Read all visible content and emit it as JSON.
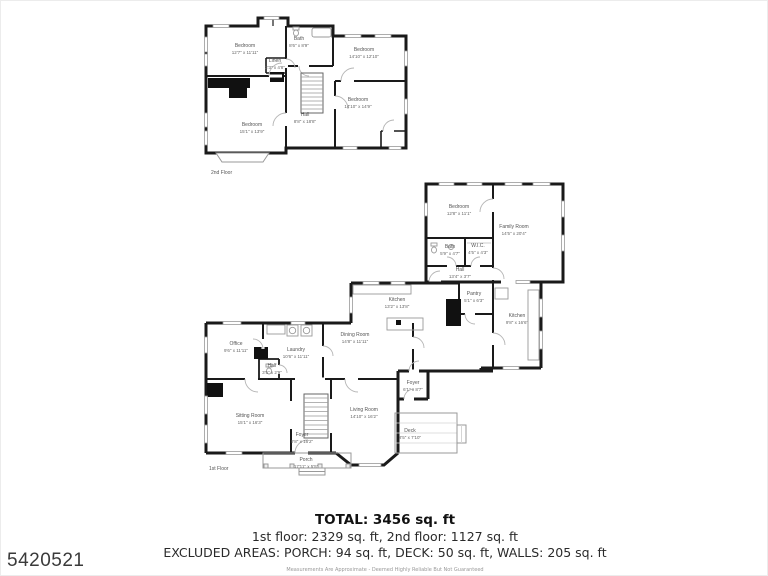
{
  "watermark": "5420521",
  "floor2": {
    "floor_label": "2nd Floor",
    "rooms": [
      {
        "name": "Bedroom",
        "dims": "12'7\" x 11'11\""
      },
      {
        "name": "Bath",
        "dims": "8'6\" x 8'9\""
      },
      {
        "name": "Linen",
        "dims": "2'3\" x 4'8\""
      },
      {
        "name": "Bedroom",
        "dims": "14'10\" x 12'10\""
      },
      {
        "name": "Bedroom",
        "dims": "14'10\" x 14'9\""
      },
      {
        "name": "Hall",
        "dims": "8'8\" x 18'8\""
      },
      {
        "name": "Bedroom",
        "dims": "15'1\" x 13'9\""
      }
    ]
  },
  "floor1": {
    "floor_label": "1st Floor",
    "rooms": [
      {
        "name": "Bedroom",
        "dims": "12'8\" x 11'1\""
      },
      {
        "name": "Family Room",
        "dims": "14'5\" x 20'4\""
      },
      {
        "name": "Bath",
        "dims": "5'9\" x 4'7\""
      },
      {
        "name": "W.I.C.",
        "dims": "4'5\" x 4'3\""
      },
      {
        "name": "Hall",
        "dims": "13'4\" x 3'7\""
      },
      {
        "name": "Kitchen",
        "dims": "13'2\" x 13'8\""
      },
      {
        "name": "Pantry",
        "dims": "5'1\" x 6'3\""
      },
      {
        "name": "Kitchen",
        "dims": "9'8\" x 16'6\""
      },
      {
        "name": "Dining Room",
        "dims": "14'8\" x 11'11\""
      },
      {
        "name": "Laundry",
        "dims": "10'6\" x 11'11\""
      },
      {
        "name": "Office",
        "dims": "9'6\" x 11'11\""
      },
      {
        "name": "Half",
        "dims": "3'5\" x 2'9\""
      },
      {
        "name": "Sitting Room",
        "dims": "15'1\" x 16'3\""
      },
      {
        "name": "Foyer",
        "dims": "9'8\" x 16'2\""
      },
      {
        "name": "Living Room",
        "dims": "14'10\" x 16'2\""
      },
      {
        "name": "Foyer",
        "dims": "6'1\" x 8'7\""
      },
      {
        "name": "Deck",
        "dims": "8'5\" x 7'10\""
      },
      {
        "name": "Porch",
        "dims": "17'11\" x 5'5\""
      }
    ]
  },
  "summary": {
    "total": "TOTAL: 3456 sq. ft",
    "floor_breakdown": "1st floor: 2329 sq. ft, 2nd floor: 1127 sq. ft",
    "excluded": "EXCLUDED AREAS: PORCH: 94 sq. ft, DECK: 50 sq. ft, WALLS: 205 sq. ft",
    "disclaimer": "Measurements Are Approximate - Deemed Highly Reliable But Not Guaranteed"
  },
  "colors": {
    "wall": "#1a1a1a",
    "fixture": "#9a9a9a",
    "label_text": "#555555"
  }
}
